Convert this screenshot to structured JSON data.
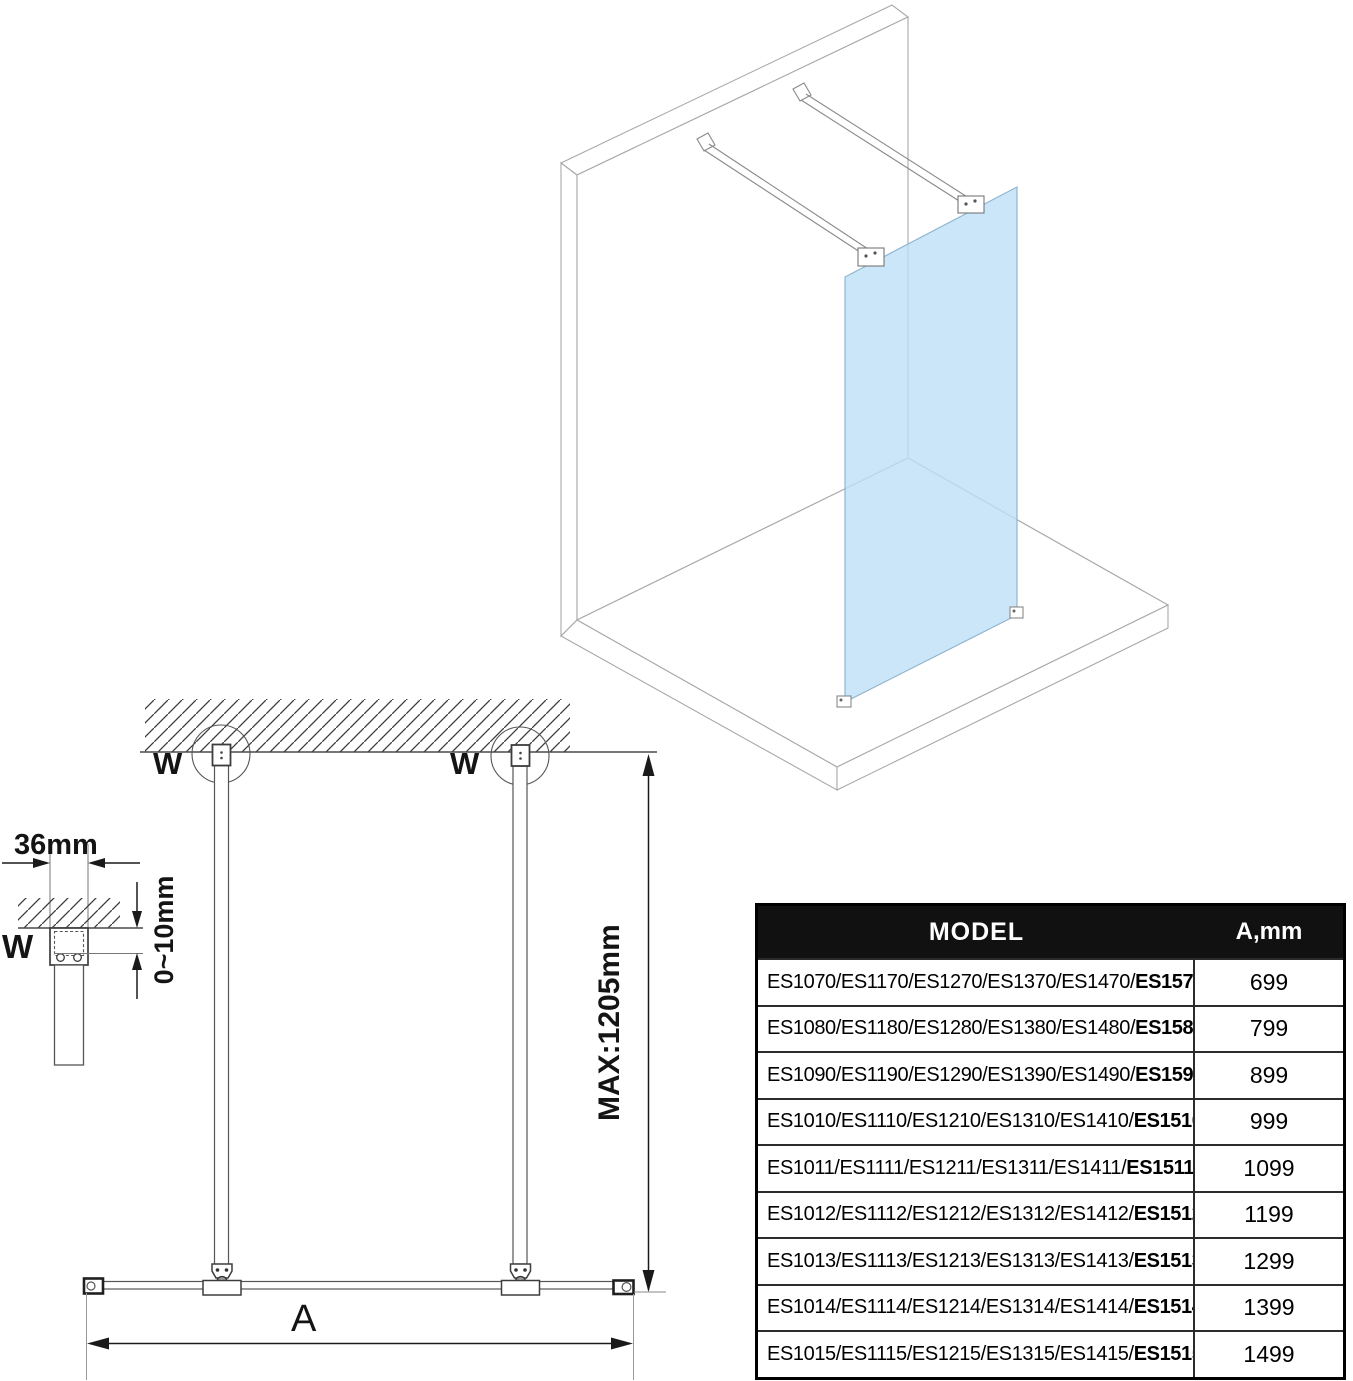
{
  "diagram": {
    "labels": {
      "detail_width": "36mm",
      "detail_gap": "0~10mm",
      "detail_marker": "W",
      "wall_marker_left": "W",
      "wall_marker_right": "W",
      "max_height": "MAX:1205mm",
      "width_dim": "A"
    },
    "colors": {
      "glass": "#cbe5f8",
      "line_3d": "#a8a8a8",
      "line_2d": "#4a4a4a",
      "dimension": "#1a1a1a",
      "table_header_bg": "#111111"
    }
  },
  "table": {
    "headers": [
      "MODEL",
      "A,mm"
    ],
    "rows": [
      {
        "regular": "ES1070/ES1170/ES1270/ES1370/ES1470/",
        "bold": "ES1570",
        "value": "699"
      },
      {
        "regular": "ES1080/ES1180/ES1280/ES1380/ES1480/",
        "bold": "ES1580",
        "value": "799"
      },
      {
        "regular": "ES1090/ES1190/ES1290/ES1390/ES1490/",
        "bold": "ES1590",
        "value": "899"
      },
      {
        "regular": "ES1010/ES1110/ES1210/ES1310/ES1410/",
        "bold": "ES1510",
        "value": "999"
      },
      {
        "regular": "ES1011/ES1111/ES1211/ES1311/ES1411/",
        "bold": "ES1511",
        "value": "1099"
      },
      {
        "regular": "ES1012/ES1112/ES1212/ES1312/ES1412/",
        "bold": "ES1512",
        "value": "1199"
      },
      {
        "regular": "ES1013/ES1113/ES1213/ES1313/ES1413/",
        "bold": "ES1513",
        "value": "1299"
      },
      {
        "regular": "ES1014/ES1114/ES1214/ES1314/ES1414/",
        "bold": "ES1514",
        "value": "1399"
      },
      {
        "regular": "ES1015/ES1115/ES1215/ES1315/ES1415/",
        "bold": "ES1515",
        "value": "1499"
      }
    ]
  }
}
